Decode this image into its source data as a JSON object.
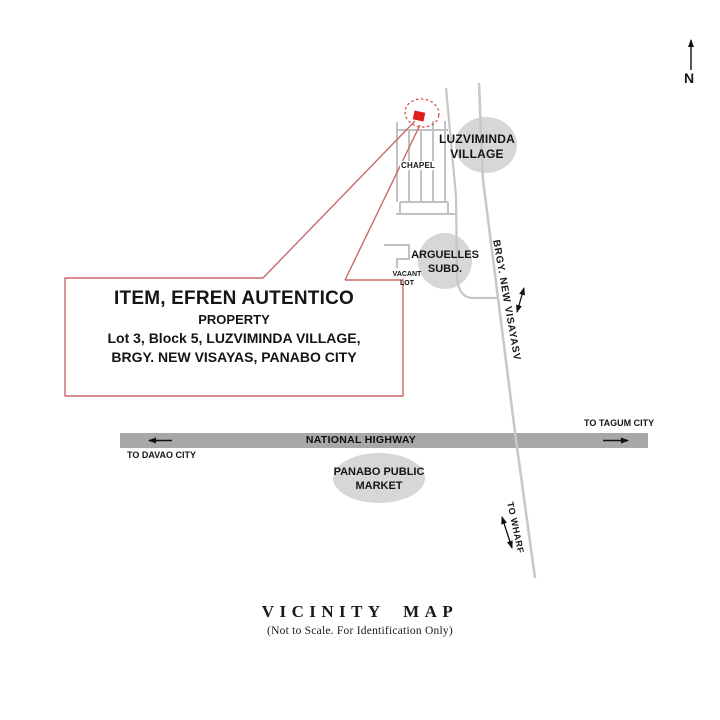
{
  "title": {
    "heading": "VICINITY MAP",
    "subheading": "(Not to Scale. For Identification Only)"
  },
  "compass": {
    "label": "N"
  },
  "property_box": {
    "lines": [
      "ITEM, EFREN AUTENTICO",
      "PROPERTY",
      "Lot 3, Block 5, LUZVIMINDA VILLAGE,",
      "BRGY. NEW VISAYAS, PANABO CITY"
    ]
  },
  "places": {
    "luzviminda": {
      "line1": "LUZVIMINDA",
      "line2": "VILLAGE"
    },
    "arguelles": {
      "line1": "ARGUELLES",
      "line2": "SUBD."
    },
    "panabo_market": {
      "line1": "PANABO PUBLIC",
      "line2": "MARKET"
    },
    "chapel": "CHAPEL",
    "vacant_lot": {
      "line1": "VACANT",
      "line2": "LOT"
    }
  },
  "roads": {
    "national_highway": "NATIONAL HIGHWAY",
    "brgy_new_visayas": "BRGY. NEW VISAYASV",
    "to_tagum": "TO TAGUM CITY",
    "to_davao": "TO DAVAO CITY",
    "to_wharf": "TO WHARF"
  },
  "colors": {
    "accent_red": "#c96a6a",
    "marker_red": "#e01f1f",
    "dashed_ellipse_red": "#e03b3b",
    "road_gray": "#c6c6c6",
    "highway_gray": "#a8a8a8",
    "ellipse_gray": "#d7d7d7"
  }
}
